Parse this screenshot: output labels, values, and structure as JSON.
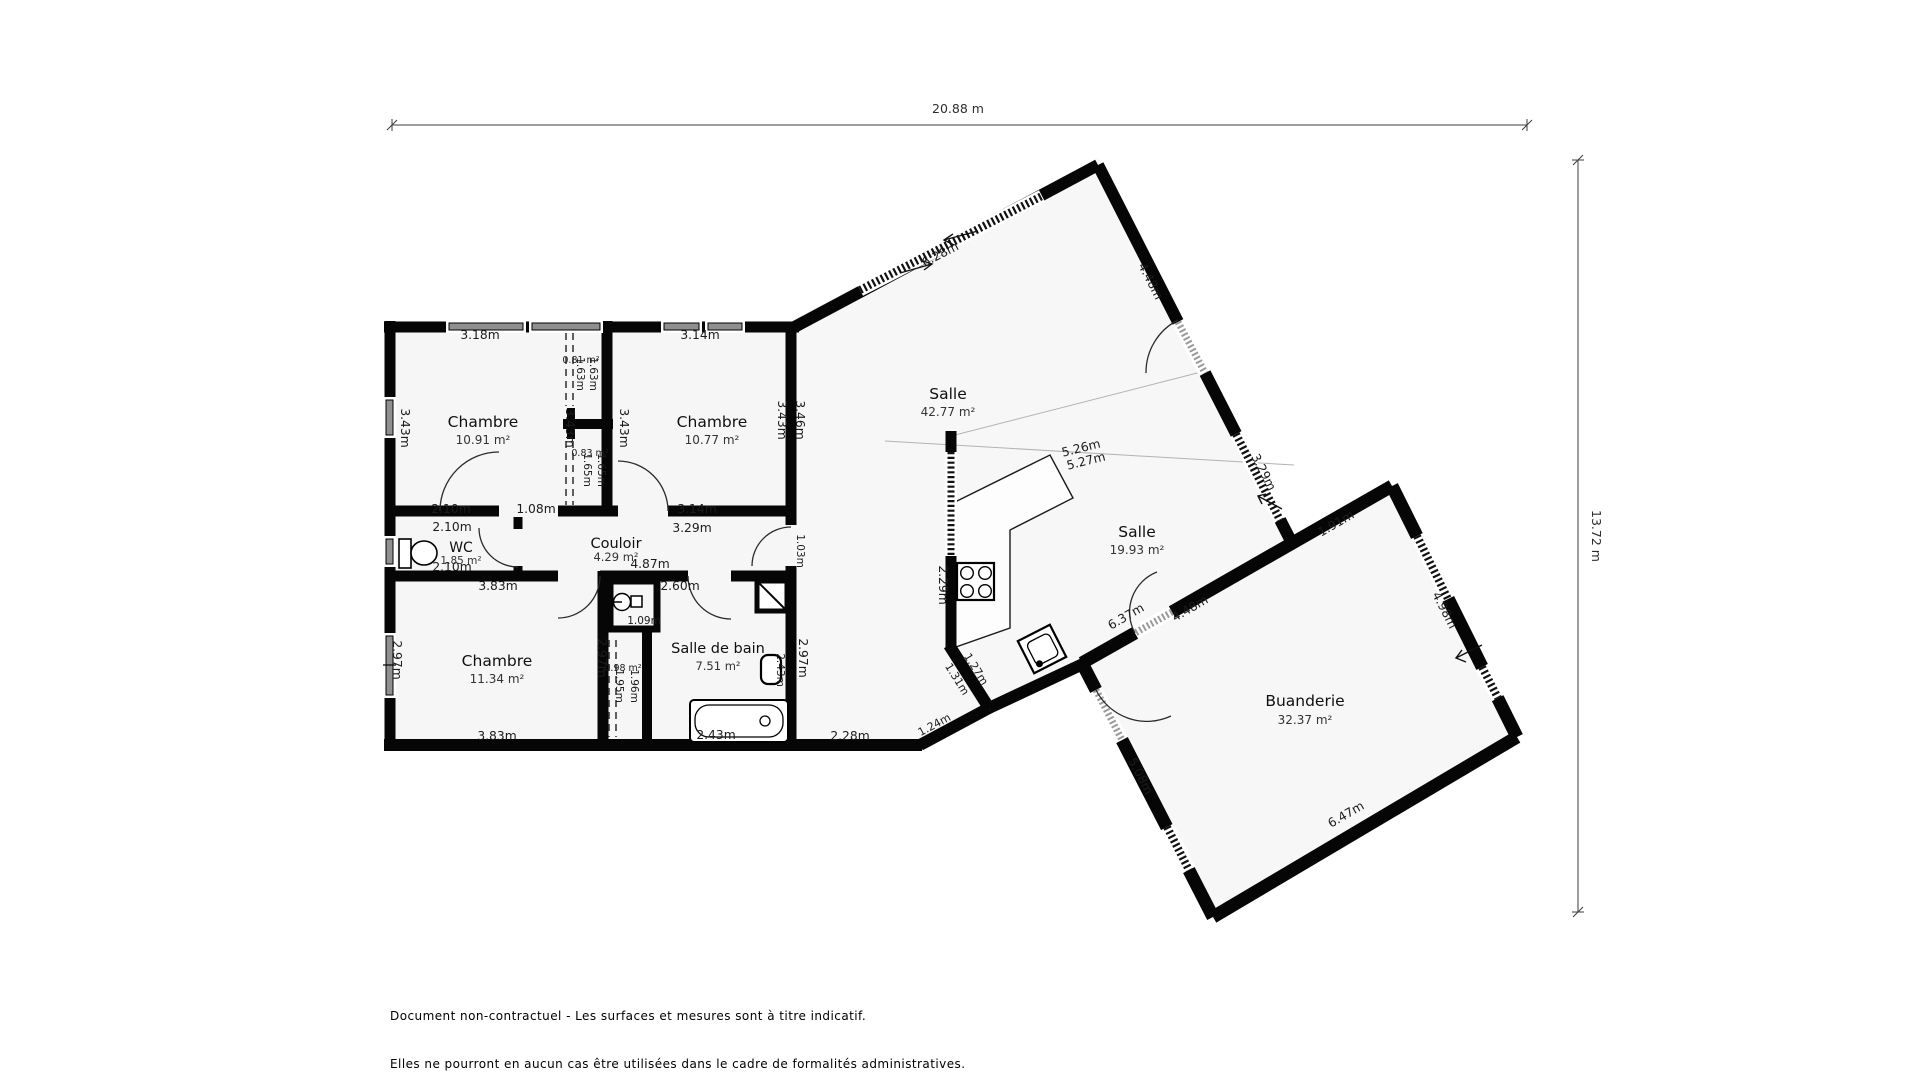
{
  "dimensions": {
    "width_label": "20.88 m",
    "height_label": "13.72 m"
  },
  "footer": {
    "line1": "Document non-contractuel - Les surfaces et mesures sont à titre indicatif.",
    "line2": "Elles ne pourront en aucun cas être utilisées dans le cadre de formalités administratives."
  },
  "plan": {
    "rooms": [
      {
        "name": "Chambre",
        "area": "10.91 m²",
        "x": 483,
        "ny": 427,
        "ay": 444
      },
      {
        "name": "Chambre",
        "area": "10.77 m²",
        "x": 712,
        "ny": 427,
        "ay": 444
      },
      {
        "name": "Salle",
        "area": "42.77 m²",
        "x": 948,
        "ny": 399,
        "ay": 416
      },
      {
        "name": "Salle",
        "area": "19.93 m²",
        "x": 1137,
        "ny": 537,
        "ay": 554
      },
      {
        "name": "WC",
        "area": "1.85 m²",
        "x": 461,
        "ny": 552,
        "ay": 564,
        "ns": 14,
        "as": 10.5
      },
      {
        "name": "Couloir",
        "area": "4.29 m²",
        "x": 616,
        "ny": 548,
        "ay": 561,
        "ns": 14.5,
        "as": 11.5
      },
      {
        "name": "Chambre",
        "area": "11.34 m²",
        "x": 497,
        "ny": 666,
        "ay": 683
      },
      {
        "name": "Salle de bain",
        "area": "7.51 m²",
        "x": 718,
        "ny": 653,
        "ay": 670,
        "ns": 14.5,
        "as": 11.5
      },
      {
        "name": "Buanderie",
        "area": "32.37 m²",
        "x": 1305,
        "ny": 706,
        "ay": 724
      }
    ],
    "measurements": [
      {
        "t": "3.18m",
        "x": 480,
        "y": 339
      },
      {
        "t": "3.14m",
        "x": 700,
        "y": 339
      },
      {
        "t": "3.43m",
        "x": 401,
        "y": 428,
        "r": 90
      },
      {
        "t": "3.43m",
        "x": 566,
        "y": 428,
        "r": 90
      },
      {
        "t": "1.63m",
        "x": 577,
        "y": 374,
        "r": 90,
        "s": 10.5
      },
      {
        "t": "1.63m",
        "x": 590,
        "y": 374,
        "r": 90,
        "s": 10.5
      },
      {
        "t": "0.81 m²",
        "x": 581,
        "y": 363,
        "s": 9.5
      },
      {
        "t": "3.43m",
        "x": 620,
        "y": 428,
        "r": 90
      },
      {
        "t": "3.43m",
        "x": 778,
        "y": 420,
        "r": 90
      },
      {
        "t": "3.46m",
        "x": 796,
        "y": 420,
        "r": 90
      },
      {
        "t": "1.65m",
        "x": 584,
        "y": 470,
        "r": 90,
        "s": 10.5
      },
      {
        "t": "1.65m",
        "x": 598,
        "y": 470,
        "r": 90,
        "s": 10.5
      },
      {
        "t": "0.83 m²",
        "x": 590,
        "y": 456,
        "s": 9.5
      },
      {
        "t": "2.10m",
        "x": 451,
        "y": 513
      },
      {
        "t": "1.08m",
        "x": 536,
        "y": 513
      },
      {
        "t": "3.14m",
        "x": 697,
        "y": 513
      },
      {
        "t": "2.10m",
        "x": 452,
        "y": 531
      },
      {
        "t": "2.10m",
        "x": 452,
        "y": 571
      },
      {
        "t": "3.29m",
        "x": 692,
        "y": 532
      },
      {
        "t": "4.87m",
        "x": 650,
        "y": 568
      },
      {
        "t": "1.03m",
        "x": 797,
        "y": 551,
        "r": 90,
        "s": 10.5
      },
      {
        "t": "3.83m",
        "x": 498,
        "y": 590
      },
      {
        "t": "2.60m",
        "x": 680,
        "y": 590
      },
      {
        "t": "1.09m",
        "x": 644,
        "y": 624,
        "s": 10.5
      },
      {
        "t": "2.97m",
        "x": 393,
        "y": 660,
        "r": 90
      },
      {
        "t": "2.97m",
        "x": 598,
        "y": 658,
        "r": 90
      },
      {
        "t": "1.95m",
        "x": 616,
        "y": 686,
        "r": 90,
        "s": 10.5
      },
      {
        "t": "1.96m",
        "x": 631,
        "y": 686,
        "r": 90,
        "s": 10.5
      },
      {
        "t": "0.98 m²",
        "x": 623,
        "y": 671,
        "s": 9.5
      },
      {
        "t": "2.43m",
        "x": 777,
        "y": 670,
        "r": 90,
        "s": 10.5
      },
      {
        "t": "2.97m",
        "x": 799,
        "y": 658,
        "r": 90
      },
      {
        "t": "2.43m",
        "x": 716,
        "y": 739
      },
      {
        "t": "3.83m",
        "x": 497,
        "y": 740
      },
      {
        "t": "6.28m",
        "x": 942,
        "y": 258,
        "r": -27
      },
      {
        "t": "4.48m",
        "x": 1147,
        "y": 283,
        "r": 63
      },
      {
        "t": "3.29m",
        "x": 1260,
        "y": 474,
        "r": 63
      },
      {
        "t": "5.26m",
        "x": 1082,
        "y": 452,
        "r": -14
      },
      {
        "t": "5.27m",
        "x": 1087,
        "y": 465,
        "r": -14
      },
      {
        "t": "2.29m",
        "x": 939,
        "y": 585,
        "r": 90
      },
      {
        "t": "1.31m",
        "x": 954,
        "y": 681,
        "r": 58,
        "s": 11
      },
      {
        "t": "1.27m",
        "x": 973,
        "y": 671,
        "r": 58,
        "s": 11
      },
      {
        "t": "2.28m",
        "x": 850,
        "y": 740
      },
      {
        "t": "1.24m",
        "x": 936,
        "y": 728,
        "r": -28,
        "s": 11
      },
      {
        "t": "6.37m",
        "x": 1128,
        "y": 620,
        "r": -30
      },
      {
        "t": "4.48m",
        "x": 1192,
        "y": 612,
        "r": -30
      },
      {
        "t": "1.91m",
        "x": 1338,
        "y": 527,
        "r": -30
      },
      {
        "t": "4.98m",
        "x": 1441,
        "y": 612,
        "r": 63
      },
      {
        "t": "5.08m",
        "x": 1137,
        "y": 778,
        "r": 63
      },
      {
        "t": "6.47m",
        "x": 1348,
        "y": 818,
        "r": -30
      }
    ]
  }
}
